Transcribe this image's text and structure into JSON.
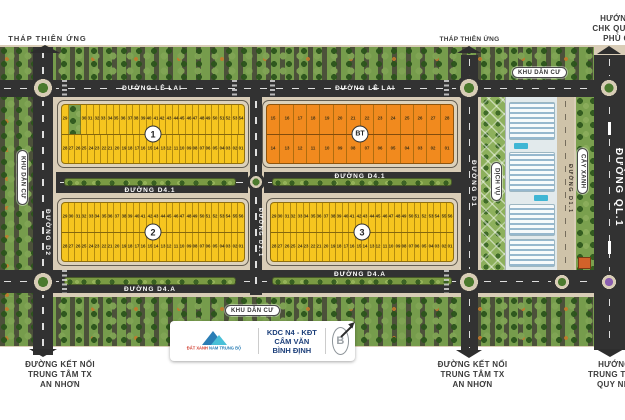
{
  "labels": {
    "thap_thien_ung": "THÁP THIÊN ỨNG",
    "khu_dan_cu": "KHU DÂN CƯ",
    "cay_xanh": "CÂY XANH",
    "dich_vu": "DỊCH VỤ"
  },
  "roads": {
    "le_lai": "ĐƯỜNG LÊ LAI",
    "d41": "ĐƯỜNG D4.1",
    "d4a": "ĐƯỜNG D4.A",
    "d2": "ĐƯỜNG D2",
    "d21": "ĐƯỜNG D2.1",
    "d1": "ĐƯỜNG D1",
    "d11": "ĐƯỜNG D1.1",
    "ql1": "ĐƯỜNG QL.1"
  },
  "directions": {
    "chk_lines": [
      "HƯỚNG ĐI",
      "CHK QUỐC TẾ",
      "PHÙ CÁT"
    ],
    "an_nhon_lines": [
      "ĐƯỜNG KẾT NỐI",
      "TRUNG TÂM TX",
      "AN NHƠN"
    ],
    "quy_nhon_lines": [
      "HƯỚNG ĐI",
      "TRUNG TÂM TP",
      "QUY NHƠN"
    ]
  },
  "footer_card": {
    "logo_text_red": "ĐẤT XANH",
    "logo_text_blue": "NAM TRUNG BỘ",
    "project_line1": "KDC N4 - KĐT CẨM VĂN",
    "project_line2": "BÌNH ĐỊNH",
    "compass_letter": "B"
  },
  "colors": {
    "lot_yellow": "#f6c51f",
    "lot_orange": "#f18a1e",
    "road": "#323232",
    "sidewalk": "#d9cdb7"
  },
  "blocks": [
    {
      "badge": "1",
      "color": "#f6c51f",
      "top": [
        "29",
        "GREEN",
        "30",
        "31",
        "32",
        "33",
        "34",
        "35",
        "36",
        "37",
        "38",
        "39",
        "40",
        "41",
        "42",
        "43",
        "44",
        "45",
        "46",
        "47",
        "48",
        "49",
        "50",
        "51",
        "52",
        "53",
        "54"
      ],
      "bottom": [
        "28",
        "27",
        "26",
        "25",
        "24",
        "23",
        "22",
        "21",
        "20",
        "19",
        "18",
        "17",
        "16",
        "15",
        "14",
        "13",
        "12",
        "11",
        "10",
        "09",
        "08",
        "07",
        "06",
        "05",
        "04",
        "03",
        "02",
        "01"
      ]
    },
    {
      "badge": "BT",
      "color": "#f18a1e",
      "top": [
        "15",
        "16",
        "17",
        "18",
        "19",
        "20",
        "21",
        "22",
        "23",
        "24",
        "25",
        "26",
        "27",
        "28"
      ],
      "bottom": [
        "14",
        "13",
        "12",
        "11",
        "10",
        "09",
        "08",
        "07",
        "06",
        "05",
        "04",
        "03",
        "02",
        "01"
      ]
    },
    {
      "badge": "2",
      "color": "#f6c51f",
      "top": [
        "29",
        "30",
        "31",
        "32",
        "33",
        "34",
        "35",
        "36",
        "37",
        "38",
        "39",
        "40",
        "41",
        "42",
        "43",
        "44",
        "45",
        "46",
        "47",
        "48",
        "49",
        "50",
        "51",
        "52",
        "53",
        "54",
        "55",
        "56"
      ],
      "bottom": [
        "28",
        "27",
        "26",
        "25",
        "24",
        "23",
        "22",
        "21",
        "20",
        "19",
        "18",
        "17",
        "16",
        "15",
        "14",
        "13",
        "12",
        "11",
        "10",
        "09",
        "08",
        "07",
        "06",
        "05",
        "04",
        "03",
        "02",
        "01"
      ]
    },
    {
      "badge": "3",
      "color": "#f6c51f",
      "top": [
        "29",
        "30",
        "31",
        "32",
        "33",
        "34",
        "35",
        "36",
        "37",
        "38",
        "39",
        "40",
        "41",
        "42",
        "43",
        "44",
        "45",
        "46",
        "47",
        "48",
        "49",
        "50",
        "51",
        "52",
        "53",
        "54",
        "55",
        "56"
      ],
      "bottom": [
        "28",
        "27",
        "26",
        "25",
        "24",
        "23",
        "22",
        "21",
        "20",
        "19",
        "18",
        "17",
        "16",
        "15",
        "14",
        "13",
        "12",
        "11",
        "10",
        "09",
        "08",
        "07",
        "06",
        "05",
        "04",
        "03",
        "02",
        "01"
      ]
    }
  ]
}
